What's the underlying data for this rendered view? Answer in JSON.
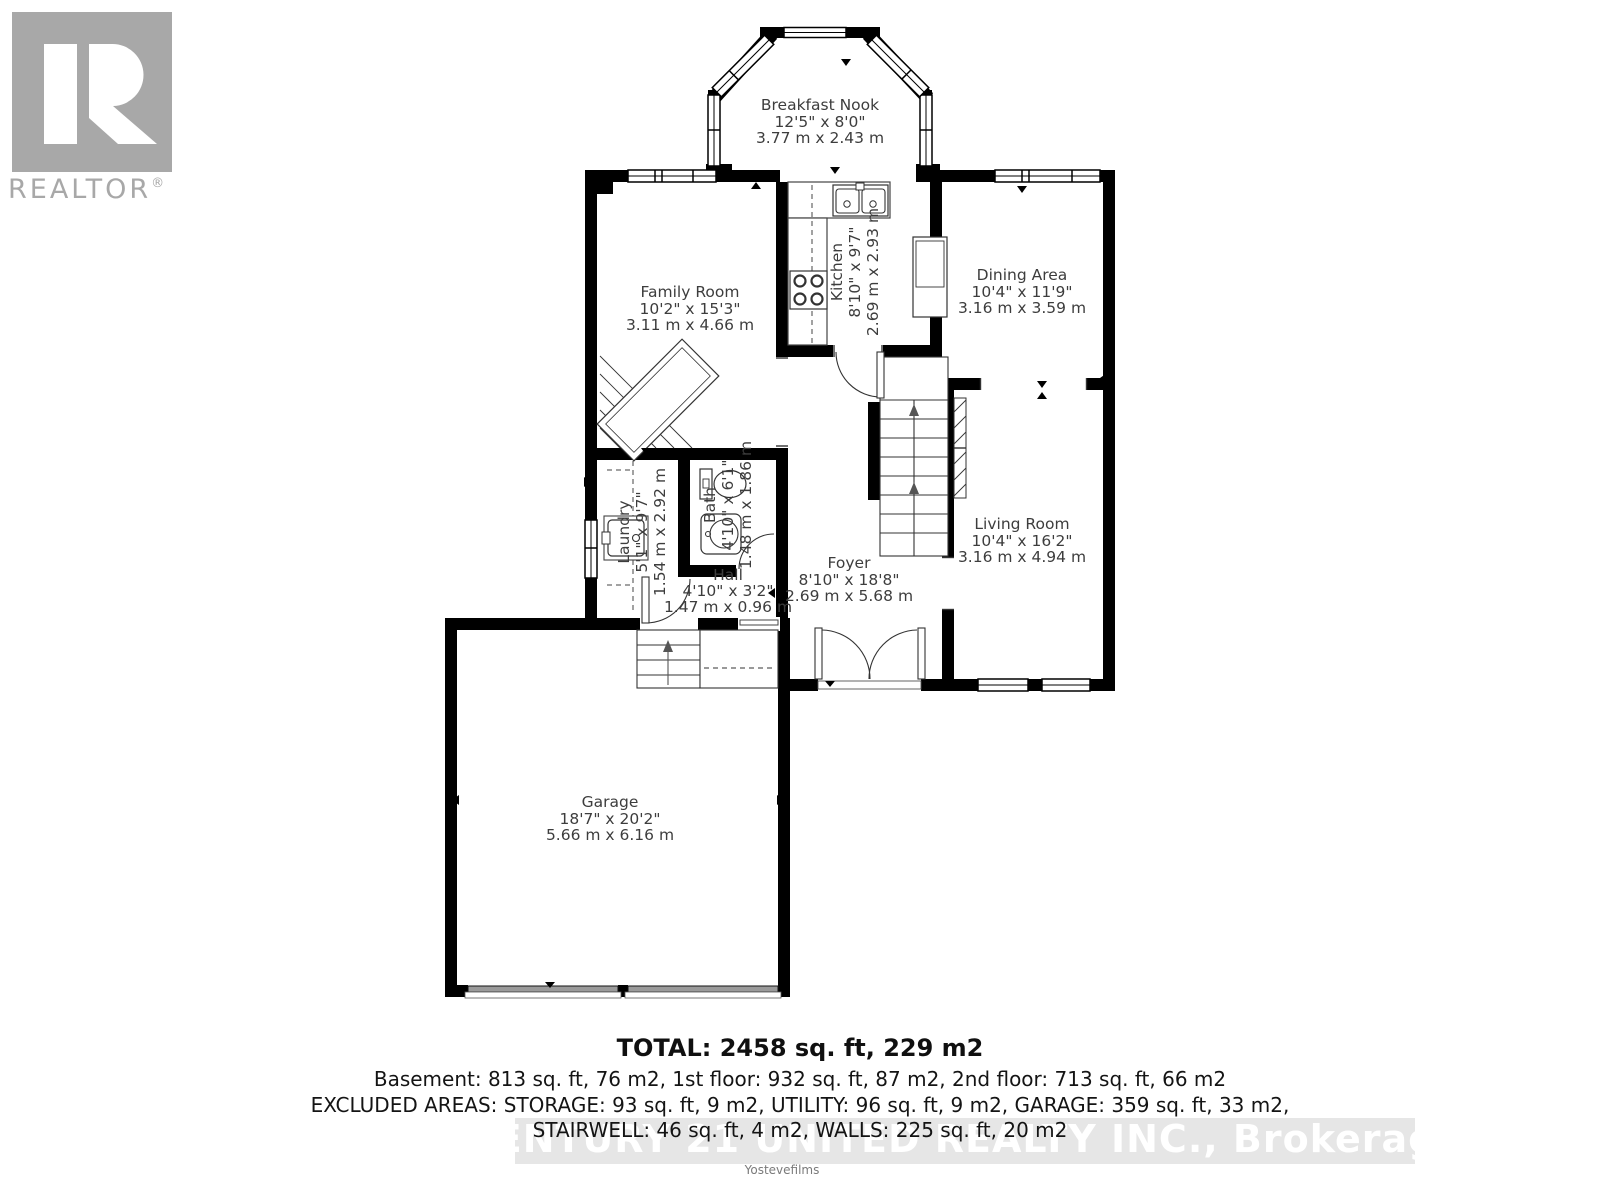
{
  "logo": {
    "name": "REALTOR",
    "reg": "®"
  },
  "rooms": {
    "breakfast_nook": {
      "name": "Breakfast Nook",
      "imperial": "12'5\" x 8'0\"",
      "metric": "3.77 m x 2.43 m"
    },
    "family_room": {
      "name": "Family Room",
      "imperial": "10'2\" x 15'3\"",
      "metric": "3.11 m x 4.66 m"
    },
    "kitchen": {
      "name": "Kitchen",
      "imperial": "8'10\" x 9'7\"",
      "metric": "2.69 m x 2.93 m"
    },
    "dining_area": {
      "name": "Dining Area",
      "imperial": "10'4\" x 11'9\"",
      "metric": "3.16 m x 3.59 m"
    },
    "living_room": {
      "name": "Living Room",
      "imperial": "10'4\" x 16'2\"",
      "metric": "3.16 m x 4.94 m"
    },
    "foyer": {
      "name": "Foyer",
      "imperial": "8'10\" x 18'8\"",
      "metric": "2.69 m x 5.68 m"
    },
    "laundry": {
      "name": "Laundry",
      "imperial": "5'1\" x 9'7\"",
      "metric": "1.54 m x 2.92 m"
    },
    "bath": {
      "name": "Bath",
      "imperial": "4'10\" x 6'1\"",
      "metric": "1.48 m x 1.86 m"
    },
    "hall": {
      "name": "Hall",
      "imperial": "4'10\" x 3'2\"",
      "metric": "1.47 m x 0.96 m"
    },
    "garage": {
      "name": "Garage",
      "imperial": "18'7\" x 20'2\"",
      "metric": "5.66 m x 6.16 m"
    }
  },
  "summary": {
    "total": "TOTAL: 2458 sq. ft, 229 m2",
    "floors": "Basement: 813 sq. ft, 76 m2, 1st floor: 932 sq. ft, 87 m2, 2nd floor: 713 sq. ft, 66 m2",
    "excluded1": "EXCLUDED AREAS: STORAGE: 93 sq. ft, 9 m2, UTILITY: 96 sq. ft, 9 m2, GARAGE: 359 sq. ft, 33 m2,",
    "excluded2": "STAIRWELL: 46 sq. ft, 4 m2, WALLS: 225 sq. ft, 20 m2"
  },
  "watermark": "CENTURY 21 UNITED REALTY INC., Brokerage",
  "credit": "Yostevefilms",
  "colors": {
    "wall": "#000000",
    "label": "#3d3d3d",
    "logo_gray": "#a8a8a8",
    "watermark_bg": "#e3e3e3",
    "watermark_text": "#ffffff"
  }
}
